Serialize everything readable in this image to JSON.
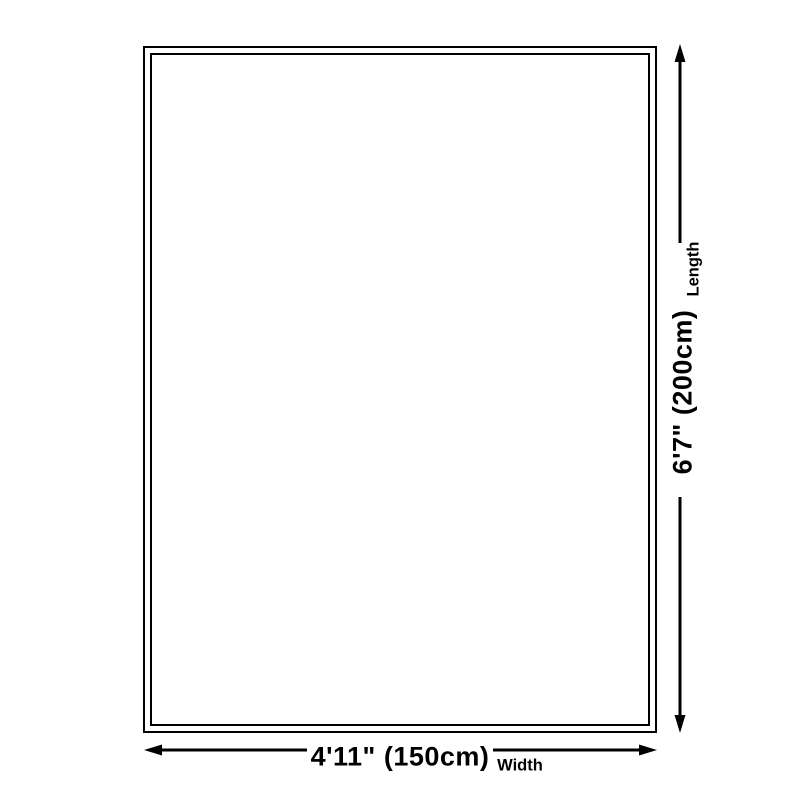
{
  "diagram": {
    "title": "rug-size-dimension-diagram",
    "length": {
      "value": "6'7\" (200cm)",
      "label": "Length"
    },
    "width": {
      "value": "4'11\" (150cm)",
      "label": "Width"
    }
  },
  "colors": {
    "ink": "#000000",
    "background": "#ffffff"
  }
}
